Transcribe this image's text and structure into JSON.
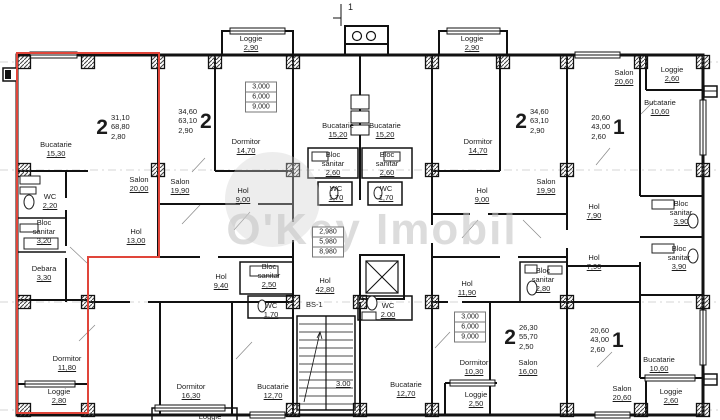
{
  "watermark": {
    "text": "O'Key Imobil"
  },
  "misc": {
    "section_mark": "1",
    "stairwell_id": "BS-1",
    "stairs_landing": "3.00"
  },
  "rooms": [
    {
      "name": "Bucatarie",
      "area": "15,30",
      "x": 56,
      "y": 140
    },
    {
      "name": "Salon",
      "area": "20,00",
      "x": 139,
      "y": 175
    },
    {
      "name": "WC",
      "area": "2,20",
      "x": 50,
      "y": 192
    },
    {
      "name": "Bloc\nsanitar",
      "area": "3,20",
      "x": 44,
      "y": 218
    },
    {
      "name": "Debara",
      "area": "3,30",
      "x": 44,
      "y": 264
    },
    {
      "name": "Hol",
      "area": "13,00",
      "x": 136,
      "y": 227
    },
    {
      "name": "Dormitor",
      "area": "11,80",
      "x": 67,
      "y": 354
    },
    {
      "name": "Loggie",
      "area": "2,80",
      "x": 59,
      "y": 387
    },
    {
      "name": "Loggie",
      "area": "2,90",
      "x": 251,
      "y": 34
    },
    {
      "name": "Dormitor",
      "area": "14,70",
      "x": 246,
      "y": 137
    },
    {
      "name": "Salon",
      "area": "19,90",
      "x": 180,
      "y": 177
    },
    {
      "name": "Hol",
      "area": "9,00",
      "x": 243,
      "y": 186
    },
    {
      "name": "Bucatarie",
      "area": "15,20",
      "x": 338,
      "y": 121
    },
    {
      "name": "Bucatarie",
      "area": "15,20",
      "x": 385,
      "y": 121
    },
    {
      "name": "Bloc\nsanitar",
      "area": "2,60",
      "x": 333,
      "y": 150
    },
    {
      "name": "Bloc\nsanitar",
      "area": "2,60",
      "x": 387,
      "y": 150
    },
    {
      "name": "WC",
      "area": "1,70",
      "x": 336,
      "y": 184
    },
    {
      "name": "WC",
      "area": "1,70",
      "x": 386,
      "y": 184
    },
    {
      "name": "Loggie",
      "area": "2,90",
      "x": 472,
      "y": 34
    },
    {
      "name": "Dormitor",
      "area": "14,70",
      "x": 478,
      "y": 137
    },
    {
      "name": "Hol",
      "area": "9,00",
      "x": 482,
      "y": 186
    },
    {
      "name": "Salon",
      "area": "19,90",
      "x": 546,
      "y": 177
    },
    {
      "name": "Salon",
      "area": "20,60",
      "x": 624,
      "y": 68
    },
    {
      "name": "Loggie",
      "area": "2,60",
      "x": 672,
      "y": 65
    },
    {
      "name": "Bucatarie",
      "area": "10,60",
      "x": 660,
      "y": 98
    },
    {
      "name": "Hol",
      "area": "7,90",
      "x": 594,
      "y": 202
    },
    {
      "name": "Bloc\nsanitar",
      "area": "3,90",
      "x": 681,
      "y": 199
    },
    {
      "name": "Hol",
      "area": "7,90",
      "x": 594,
      "y": 253
    },
    {
      "name": "Bloc\nsanitar",
      "area": "3,90",
      "x": 679,
      "y": 244
    },
    {
      "name": "Bucatarie",
      "area": "10,60",
      "x": 659,
      "y": 355
    },
    {
      "name": "Salon",
      "area": "20,60",
      "x": 622,
      "y": 384
    },
    {
      "name": "Loggie",
      "area": "2,60",
      "x": 671,
      "y": 387
    },
    {
      "name": "Hol",
      "area": "11,90",
      "x": 467,
      "y": 279
    },
    {
      "name": "Bloc\nsanitar",
      "area": "2,80",
      "x": 543,
      "y": 266
    },
    {
      "name": "Dormitor",
      "area": "10,30",
      "x": 474,
      "y": 358
    },
    {
      "name": "Salon",
      "area": "16,00",
      "x": 528,
      "y": 358
    },
    {
      "name": "Loggie",
      "area": "2,50",
      "x": 476,
      "y": 390
    },
    {
      "name": "Hol",
      "area": "9,40",
      "x": 221,
      "y": 272
    },
    {
      "name": "Bloc\nsanitar",
      "area": "2,50",
      "x": 269,
      "y": 262
    },
    {
      "name": "WC",
      "area": "1,70",
      "x": 271,
      "y": 301
    },
    {
      "name": "Dormitor",
      "area": "16,30",
      "x": 191,
      "y": 382
    },
    {
      "name": "Bucatarie",
      "area": "12,70",
      "x": 273,
      "y": 382
    },
    {
      "name": "Hol",
      "area": "42,80",
      "x": 325,
      "y": 276
    },
    {
      "name": "WC",
      "area": "2.00",
      "x": 388,
      "y": 301
    },
    {
      "name": "Bucatarie",
      "area": "12,70",
      "x": 406,
      "y": 380
    },
    {
      "name": "Loggie",
      "area": "",
      "x": 210,
      "y": 412
    }
  ],
  "apartments": [
    {
      "digit": "2",
      "values": [
        "31,10",
        "68,80",
        "2,80"
      ],
      "digit_side": "left",
      "x": 113,
      "y": 127
    },
    {
      "digit": "2",
      "values": [
        "34,60",
        "63,10",
        "2,90"
      ],
      "digit_side": "right",
      "x": 195,
      "y": 121
    },
    {
      "digit": "2",
      "values": [
        "34,60",
        "63,10",
        "2,90"
      ],
      "digit_side": "left",
      "x": 532,
      "y": 121
    },
    {
      "digit": "1",
      "values": [
        "20,60",
        "43,00",
        "2,60"
      ],
      "digit_side": "right",
      "x": 608,
      "y": 127
    },
    {
      "digit": "1",
      "values": [
        "20,60",
        "43,00",
        "2,60"
      ],
      "digit_side": "right",
      "x": 607,
      "y": 340
    },
    {
      "digit": "2",
      "values": [
        "26,30",
        "55,70",
        "2,50"
      ],
      "digit_side": "left",
      "x": 521,
      "y": 337
    }
  ],
  "tables": [
    {
      "rows": [
        "3,000",
        "6,000",
        "9,000"
      ],
      "x": 261,
      "y": 97
    },
    {
      "rows": [
        "2,980",
        "5,980",
        "8,980"
      ],
      "x": 328,
      "y": 242
    },
    {
      "rows": [
        "3,000",
        "6,000",
        "9,000"
      ],
      "x": 470,
      "y": 327
    }
  ],
  "highlight": {
    "color": "#e0453a"
  }
}
